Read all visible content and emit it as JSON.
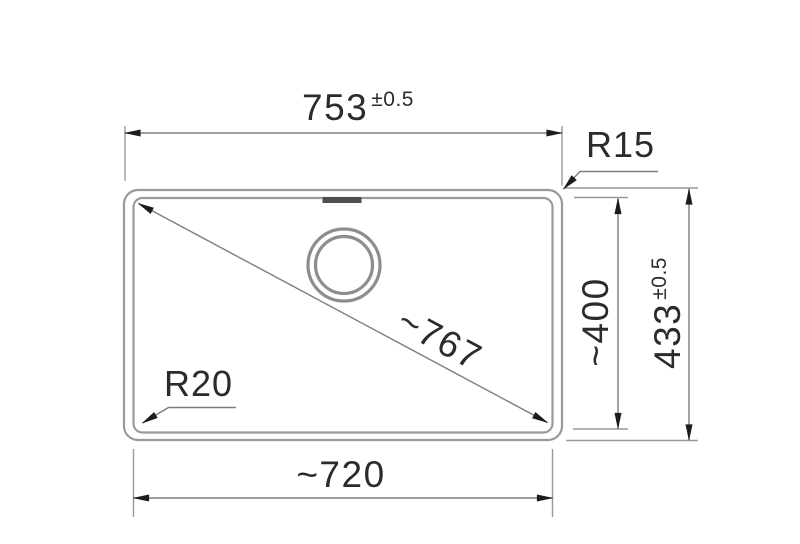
{
  "drawing": {
    "type": "technical-dimension-drawing",
    "dimensions": {
      "overall_width": {
        "value": "753",
        "tolerance": "±0.5"
      },
      "overall_depth": {
        "value": "433",
        "tolerance": "±0.5"
      },
      "basin_width": {
        "value": "~720"
      },
      "basin_depth": {
        "value": "~400"
      },
      "diagonal": {
        "value": "~767"
      },
      "radius_outer_corner": "R15",
      "radius_basin_corner": "R20"
    },
    "colors": {
      "background": "#ffffff",
      "outline_stroke": "#9a9a9a",
      "dimension_stroke": "#7d7d7d",
      "arrowhead": "#1c1c1c",
      "label_text": "#2b2b2b",
      "overflow_mark": "#4f4f4f"
    }
  }
}
